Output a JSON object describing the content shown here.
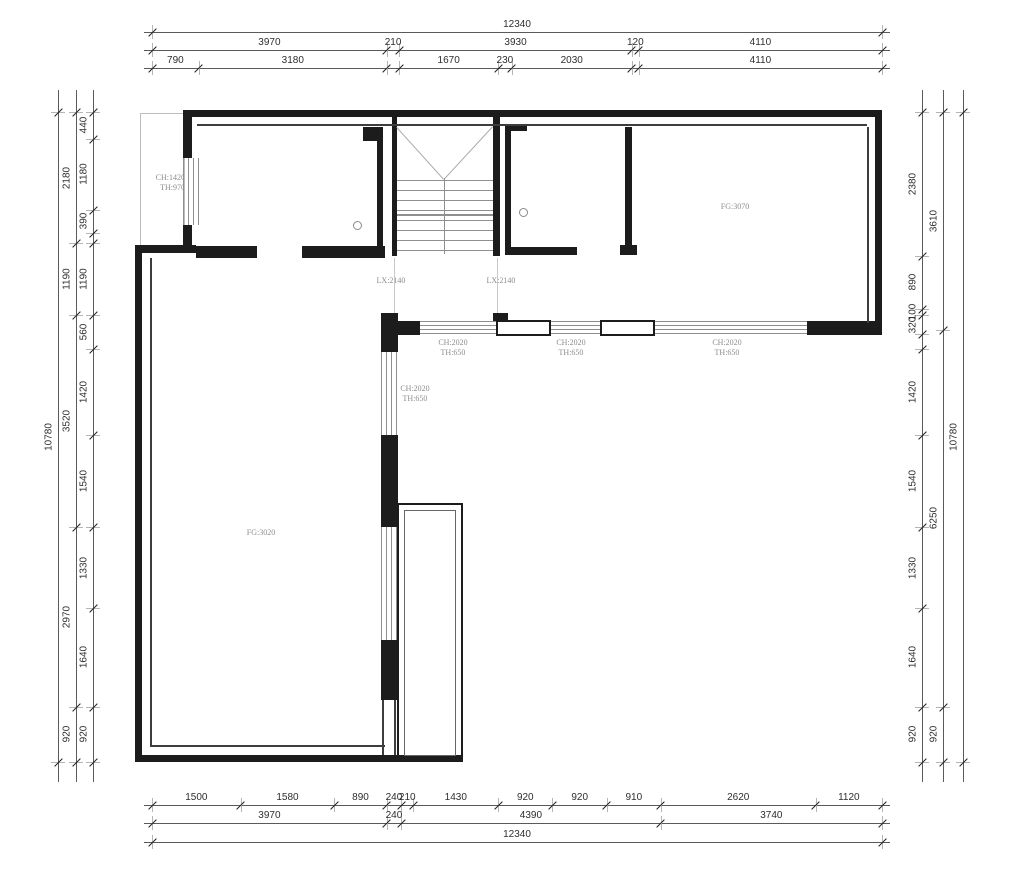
{
  "drawing": {
    "title": "floor-plan",
    "interior_labels": {
      "window_left": [
        "CH:1420",
        "TH:970"
      ],
      "lx_left": [
        "LX:2140"
      ],
      "lx_right": [
        "LX:2140"
      ],
      "room_right": [
        "FG:3070"
      ],
      "room_left": [
        "FG:3020"
      ],
      "win_vertical": [
        "CH:2020",
        "TH:650"
      ],
      "win_a": [
        "CH:2020",
        "TH:650"
      ],
      "win_b": [
        "CH:2020",
        "TH:650"
      ],
      "win_c": [
        "CH:2020",
        "TH:650"
      ]
    },
    "dimensions": {
      "top": {
        "row1": [
          {
            "label": "12340",
            "mm": 12340
          }
        ],
        "row2": [
          {
            "label": "3970",
            "mm": 3970
          },
          {
            "label": "210",
            "mm": 210
          },
          {
            "label": "3930",
            "mm": 3930
          },
          {
            "label": "120",
            "mm": 120
          },
          {
            "label": "4110",
            "mm": 4110
          }
        ],
        "row3": [
          {
            "label": "790",
            "mm": 790
          },
          {
            "label": "3180",
            "mm": 3180
          },
          {
            "label": "",
            "mm": 210
          },
          {
            "label": "1670",
            "mm": 1670
          },
          {
            "label": "230",
            "mm": 230
          },
          {
            "label": "2030",
            "mm": 2030
          },
          {
            "label": "",
            "mm": 120
          },
          {
            "label": "4110",
            "mm": 4110
          }
        ]
      },
      "bottom": {
        "row1": [
          {
            "label": "1500",
            "mm": 1500
          },
          {
            "label": "1580",
            "mm": 1580
          },
          {
            "label": "890",
            "mm": 890
          },
          {
            "label": "240",
            "mm": 240
          },
          {
            "label": "210",
            "mm": 210
          },
          {
            "label": "1430",
            "mm": 1430
          },
          {
            "label": "920",
            "mm": 920
          },
          {
            "label": "920",
            "mm": 920
          },
          {
            "label": "910",
            "mm": 910
          },
          {
            "label": "2620",
            "mm": 2620
          },
          {
            "label": "1120",
            "mm": 1120
          }
        ],
        "row2": [
          {
            "label": "3970",
            "mm": 3970
          },
          {
            "label": "240",
            "mm": 240
          },
          {
            "label": "4390",
            "mm": 4390
          },
          {
            "label": "3740",
            "mm": 3740
          }
        ],
        "row3": [
          {
            "label": "12340",
            "mm": 12340
          }
        ]
      },
      "left": {
        "outer": [
          {
            "label": "10780",
            "mm": 10780
          }
        ],
        "middle": [
          {
            "label": "2180",
            "mm": 2180
          },
          {
            "label": "1190",
            "mm": 1190
          },
          {
            "label": "3520",
            "mm": 3520
          },
          {
            "label": "2970",
            "mm": 2970
          },
          {
            "label": "920",
            "mm": 920
          }
        ],
        "inner": [
          {
            "label": "440",
            "mm": 440
          },
          {
            "label": "1180",
            "mm": 1180
          },
          {
            "label": "390",
            "mm": 390
          },
          {
            "label": "",
            "mm": 170
          },
          {
            "label": "1190",
            "mm": 1190
          },
          {
            "label": "560",
            "mm": 560
          },
          {
            "label": "1420",
            "mm": 1420
          },
          {
            "label": "1540",
            "mm": 1540
          },
          {
            "label": "1330",
            "mm": 1330
          },
          {
            "label": "1640",
            "mm": 1640
          },
          {
            "label": "920",
            "mm": 920
          }
        ]
      },
      "right": {
        "inner": [
          {
            "label": "2380",
            "mm": 2380
          },
          {
            "label": "890",
            "mm": 890
          },
          {
            "label": "100",
            "mm": 100
          },
          {
            "label": "320",
            "mm": 320
          },
          {
            "label": "",
            "mm": 240
          },
          {
            "label": "1420",
            "mm": 1420
          },
          {
            "label": "1540",
            "mm": 1540
          },
          {
            "label": "1330",
            "mm": 1330
          },
          {
            "label": "1640",
            "mm": 1640
          },
          {
            "label": "920",
            "mm": 920
          }
        ],
        "middle": [
          {
            "label": "3610",
            "mm": 3610
          },
          {
            "label": "6250",
            "mm": 6250
          },
          {
            "label": "920",
            "mm": 920
          }
        ],
        "outer": [
          {
            "label": "10780",
            "mm": 10780
          }
        ]
      }
    },
    "colors": {
      "wall": "#1c1c1c",
      "dim_text": "#2e2e2e",
      "plan_text": "#8d8d8d",
      "background": "#ffffff"
    }
  }
}
